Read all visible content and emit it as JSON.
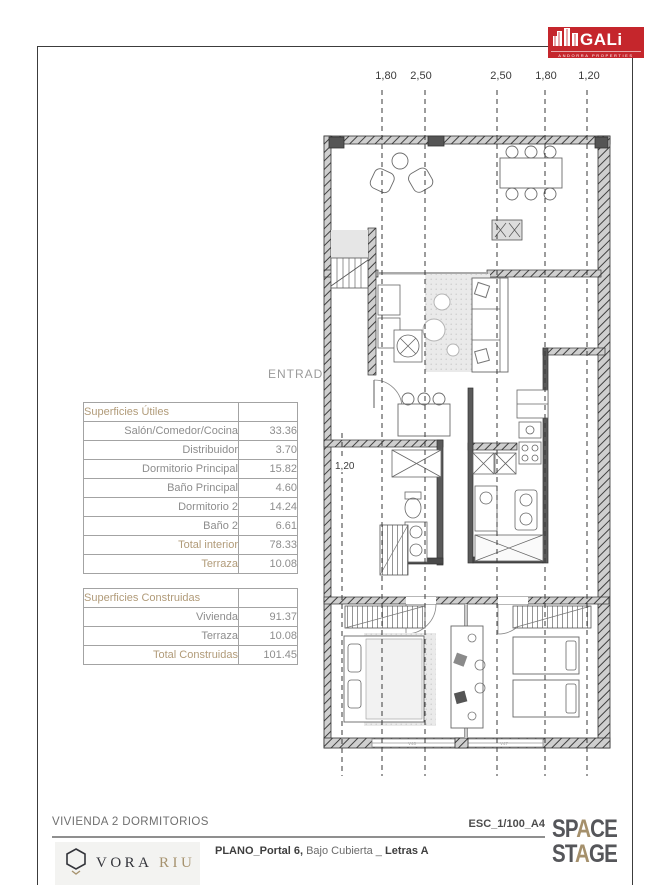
{
  "header": {
    "gali": {
      "title": "GALi",
      "subtitle": "ANDORRA PROPERTIES",
      "color": "#c5262c"
    },
    "dims": [
      {
        "label": "1,80"
      },
      {
        "label": "2,50"
      },
      {
        "label": "2,50"
      },
      {
        "label": "1,80"
      },
      {
        "label": "1,20"
      }
    ]
  },
  "plan": {
    "entrada": "ENTRADA",
    "inner_dim": "1,20",
    "window_left": "V46",
    "window_right": "V47"
  },
  "surfaces_utiles": {
    "title": "Superficies Útiles",
    "rows": [
      {
        "label": "Salón/Comedor/Cocina",
        "value": "33.36"
      },
      {
        "label": "Distribuidor",
        "value": "3.70"
      },
      {
        "label": "Dormitorio Principal",
        "value": "15.82"
      },
      {
        "label": "Baño Principal",
        "value": "4.60"
      },
      {
        "label": "Dormitorio 2",
        "value": "14.24"
      },
      {
        "label": "Baño 2",
        "value": "6.61"
      },
      {
        "label": "Total interior",
        "value": "78.33"
      },
      {
        "label": "Terraza",
        "value": "10.08"
      }
    ]
  },
  "surfaces_construidas": {
    "title": "Superficies Construidas",
    "rows": [
      {
        "label": "Vivienda",
        "value": "91.37"
      },
      {
        "label": "Terraza",
        "value": "10.08"
      },
      {
        "label": "Total Construidas",
        "value": "101.45"
      }
    ]
  },
  "footer": {
    "unit_title": "VIVIENDA 2 DORMITORIOS",
    "scale": "ESC_1/100_A4",
    "plano_bold": "PLANO_Portal 6,",
    "plano_regular": " Bajo Cubierta _ ",
    "plano_bold2": "Letras A",
    "vora": {
      "name_dark": "VORA ",
      "name_tan": "RIU"
    },
    "space_stage": {
      "l1a": "SP",
      "l1b": "A",
      "l1c": "CE",
      "l2a": "ST",
      "l2b": "A",
      "l2c": "GE"
    }
  },
  "colors": {
    "accent_red": "#c5262c",
    "tan": "#b19b79",
    "gray_text": "#8d8d8d"
  }
}
